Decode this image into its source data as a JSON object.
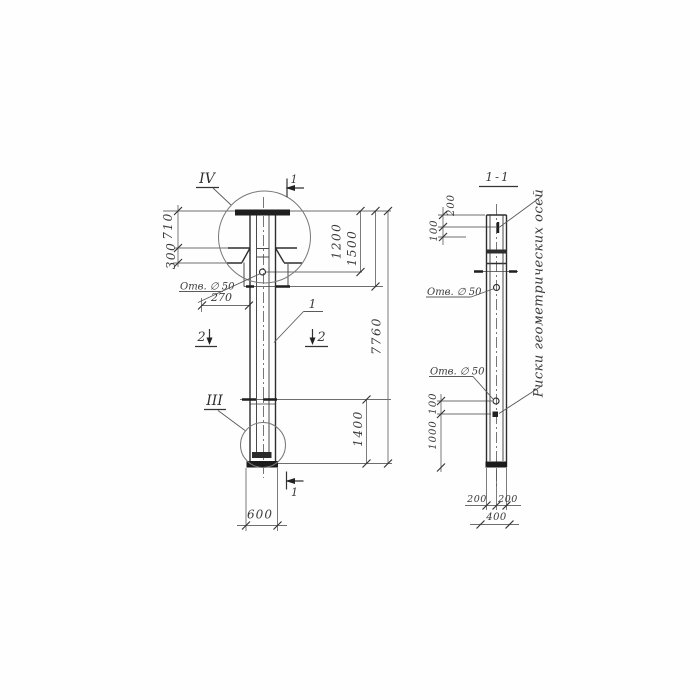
{
  "drawing": {
    "kind": "construction drawing of a pile column, elevation and section",
    "line_color": "#2e2e2e",
    "elevation": {
      "detail_mark_top": "IV",
      "detail_mark_bottom": "III",
      "section_mark_1": "1",
      "section_mark_2": "2",
      "callout_shaft": "1",
      "hole_label": "Отв. ∅ 50",
      "dim_710": "710",
      "dim_300": "300",
      "dim_270": "270",
      "dim_1200": "1200",
      "dim_1500": "1500",
      "dim_7760": "7760",
      "dim_1400": "1400",
      "dim_600": "600"
    },
    "section": {
      "title": "1-1",
      "dim_200_top": "200",
      "dim_100_top": "100",
      "hole_label_upper": "Отв. ∅ 50",
      "hole_label_lower": "Отв. ∅ 50",
      "dim_100_lower": "100",
      "dim_1000": "1000",
      "dim_200_bottom_left": "200",
      "dim_200_bottom_right": "200",
      "dim_400": "400",
      "axes_note": "Риски геометрических осей"
    }
  }
}
